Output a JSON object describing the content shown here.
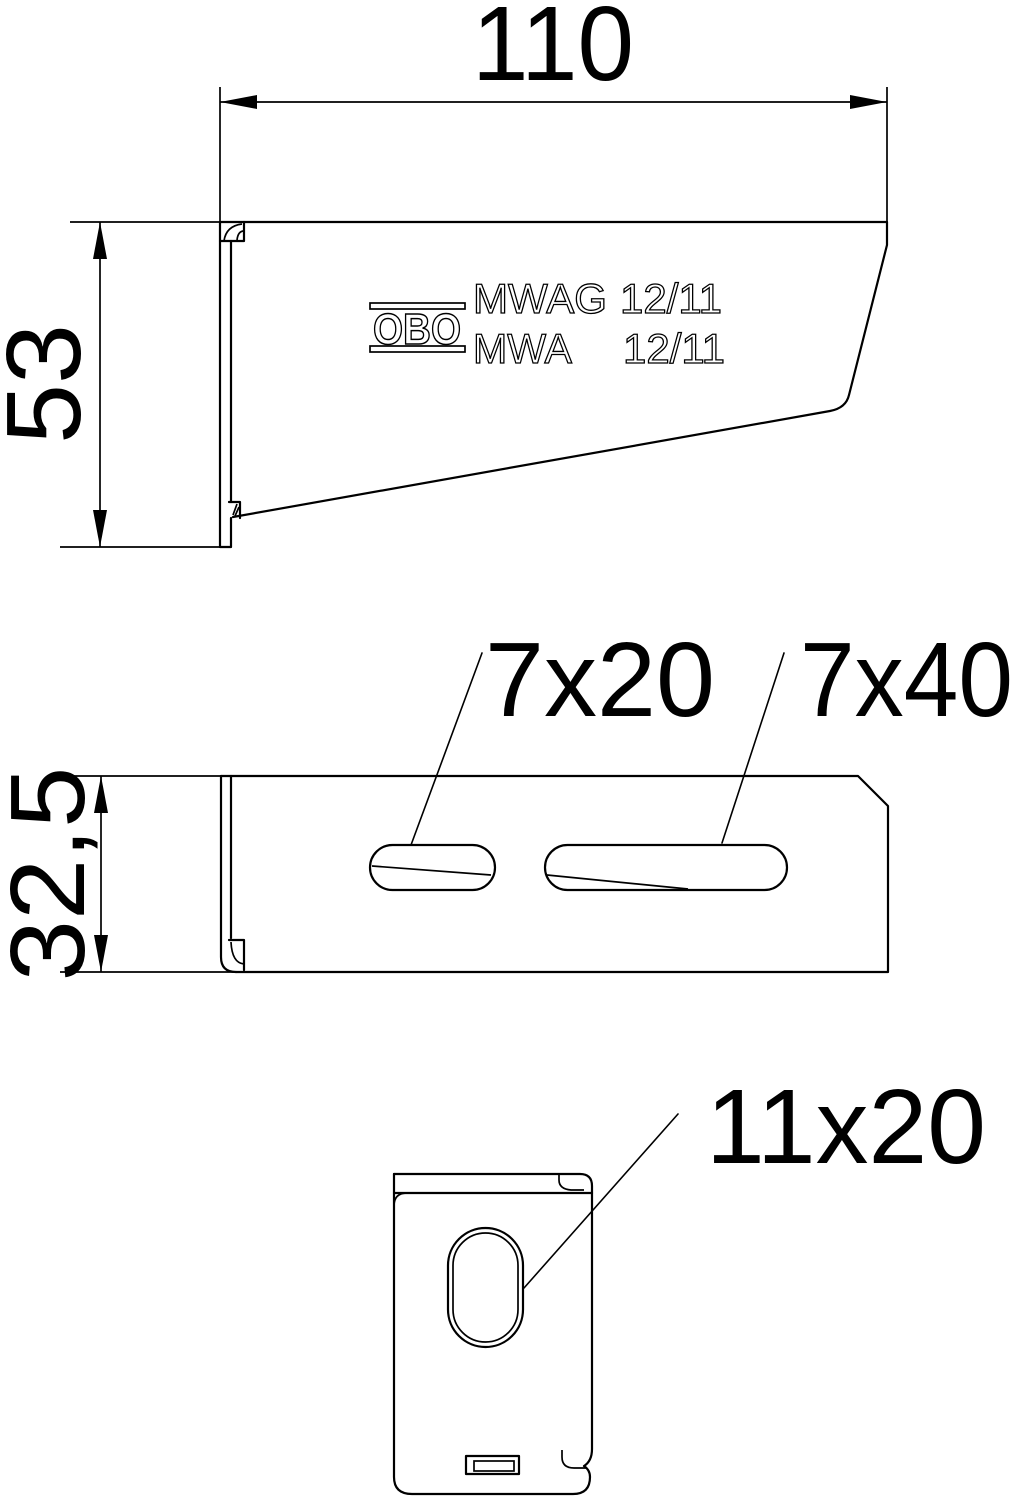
{
  "drawing": {
    "background": "#ffffff",
    "line_color": "#000000",
    "side_view": {
      "dim_width": "110",
      "dim_height": "53",
      "stamp": {
        "logo": "OBO",
        "line1_model": "MWAG",
        "line1_size": "12/11",
        "line2_model": "MWA",
        "line2_size": "12/11"
      }
    },
    "top_view": {
      "dim_height": "32,5",
      "slot_small_label": "7x20",
      "slot_large_label": "7x40"
    },
    "end_view": {
      "hole_label": "11x20"
    }
  }
}
